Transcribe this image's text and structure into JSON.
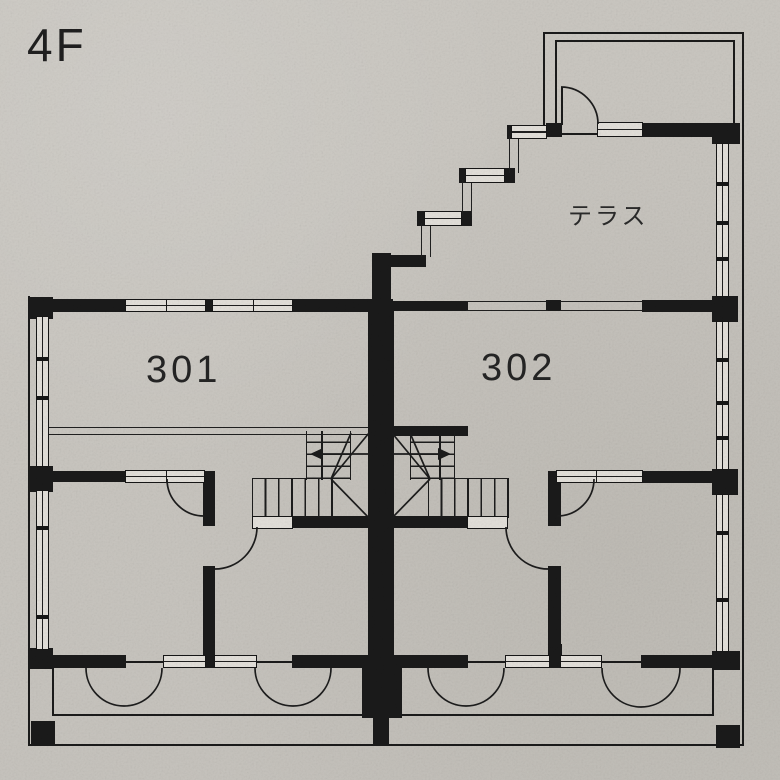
{
  "title": {
    "floor_label": "4F"
  },
  "rooms": [
    {
      "id": "301",
      "label": "301"
    },
    {
      "id": "302",
      "label": "302"
    }
  ],
  "terrace": {
    "label": "テラス"
  },
  "plan": {
    "type": "architectural-floor-plan",
    "features": [
      "two-unit floor",
      "central double switchback staircase",
      "stepped terrace wall",
      "penthouse stair bulkhead",
      "balcony with four swing doors"
    ]
  },
  "colors": {
    "paper": "#c9c6c0",
    "ink": "#1a1a1a",
    "window_fill": "#e3e0da"
  }
}
